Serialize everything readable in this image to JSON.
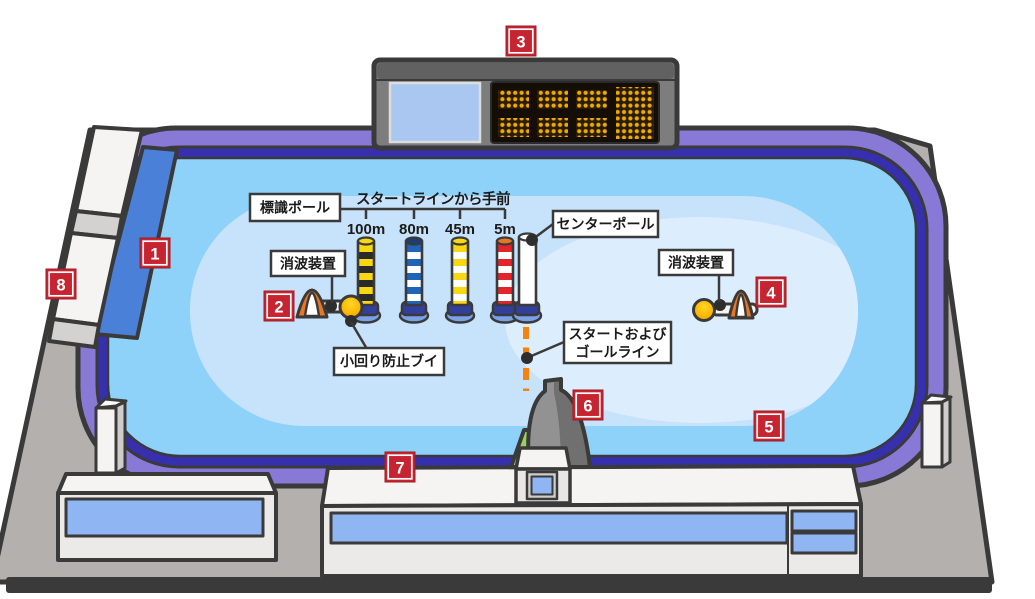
{
  "diagram": {
    "badges": [
      "1",
      "2",
      "3",
      "4",
      "5",
      "6",
      "7",
      "8"
    ],
    "labels": {
      "marker_pole": "標識ポール",
      "distance_caption": "スタートラインから手前",
      "d100": "100m",
      "d80": "80m",
      "d45": "45m",
      "d5": "5m",
      "center_pole": "センターポール",
      "wave_damper": "消波装置",
      "small_turn_buoy": "小回り防止ブイ",
      "start_goal_line_1": "スタートおよび",
      "start_goal_line_2": "ゴールライン"
    },
    "colors": {
      "badge_red": "#c52430",
      "water": "#8ed2f9",
      "infield": "#c7e2fb",
      "infield_highlight": "#dcedfe",
      "rim_purple": "#8779d5",
      "rim_indigo": "#3730ae",
      "ground_gray": "#b3b0ad",
      "pit_ramp_blue": "#4a80d8",
      "start_line_orange": "#f5820b",
      "led_amber": "#edaa00",
      "window_blue": "#8fb5f2",
      "tower_base_green": "#9bcf60",
      "pole_yellow": "#f8d813",
      "pole_blue": "#1e65b8",
      "pole_red": "#e3242b",
      "outline": "#3a3a3a"
    }
  }
}
